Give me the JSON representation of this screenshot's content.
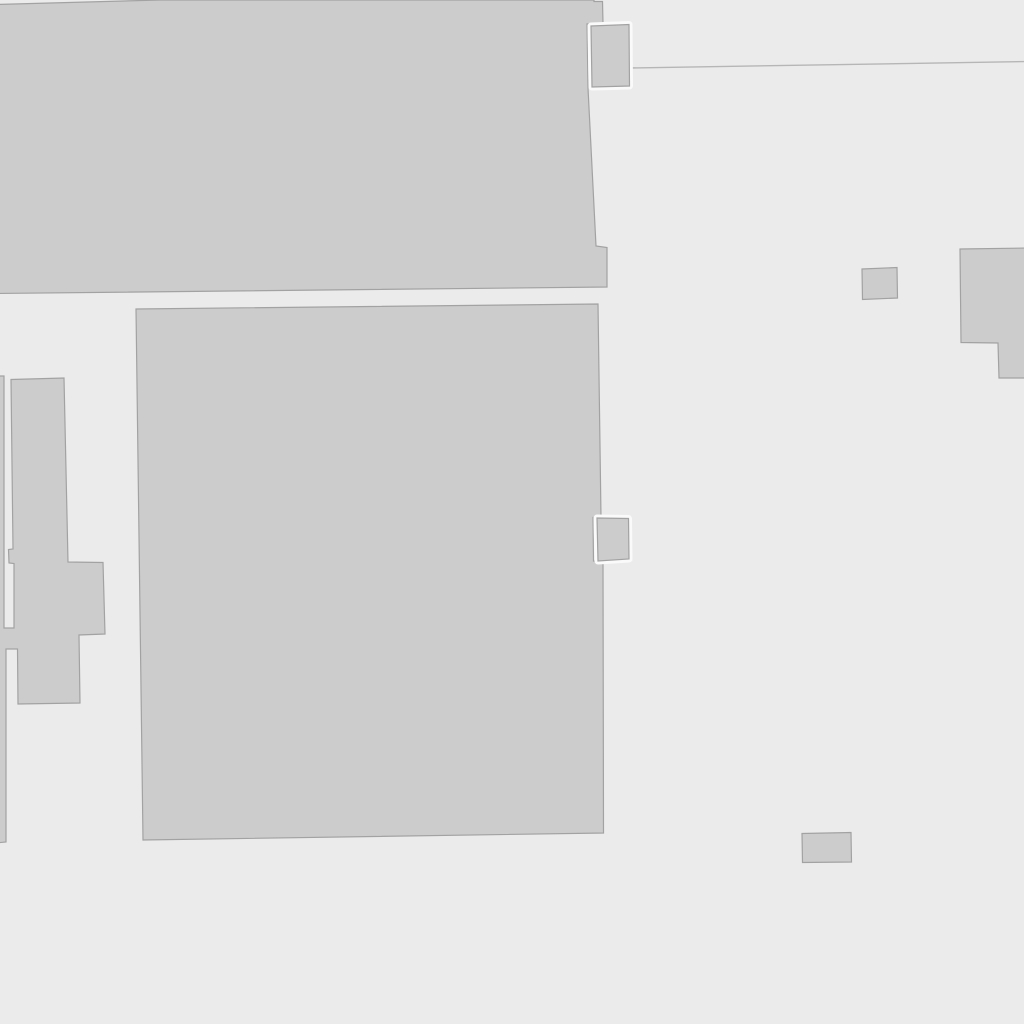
{
  "map": {
    "canvas": {
      "width": 1024,
      "height": 1024
    },
    "colors": {
      "background": "#ebebeb",
      "building_fill": "#cccccc",
      "building_stroke": "#a2a2a2",
      "halo": "#fafafa",
      "boundary_line": "#b6b6b6"
    },
    "shapes": [
      {
        "data_name": "building-footprint-top-left",
        "type": "polygon",
        "interactable": true,
        "fill": "building_fill",
        "stroke": "building_stroke",
        "stroke_width": 1.2,
        "points": [
          [
            -4,
            4.5
          ],
          [
            160,
            0
          ],
          [
            594,
            0
          ],
          [
            594,
            1.5
          ],
          [
            602.5,
            1.5
          ],
          [
            603,
            23
          ],
          [
            587,
            24
          ],
          [
            588,
            88
          ],
          [
            596,
            246
          ],
          [
            607,
            247.5
          ],
          [
            607,
            287
          ],
          [
            -4,
            293.5
          ]
        ]
      },
      {
        "data_name": "building-footprint-left-complex",
        "type": "polygon",
        "interactable": true,
        "fill": "building_fill",
        "stroke": "building_stroke",
        "stroke_width": 1.2,
        "points": [
          [
            11,
            379.5
          ],
          [
            64,
            378
          ],
          [
            68,
            562
          ],
          [
            103,
            562.5
          ],
          [
            105,
            634
          ],
          [
            79,
            635
          ],
          [
            80,
            703
          ],
          [
            18,
            704
          ],
          [
            17.5,
            649
          ],
          [
            6,
            649
          ],
          [
            6,
            842
          ],
          [
            -5,
            843
          ],
          [
            -5,
            376
          ],
          [
            4,
            376
          ],
          [
            4,
            628
          ],
          [
            14,
            628
          ],
          [
            14,
            563.5
          ],
          [
            9,
            563
          ],
          [
            8.5,
            549.5
          ],
          [
            13,
            549
          ]
        ]
      },
      {
        "data_name": "building-footprint-center-large",
        "type": "polygon",
        "interactable": true,
        "fill": "building_fill",
        "stroke": "building_stroke",
        "stroke_width": 1.2,
        "points": [
          [
            136,
            309
          ],
          [
            598,
            304
          ],
          [
            601,
            517
          ],
          [
            593,
            517.5
          ],
          [
            593.5,
            561
          ],
          [
            603,
            561.5
          ],
          [
            603.5,
            833
          ],
          [
            143,
            840
          ]
        ]
      },
      {
        "data_name": "boundary-line",
        "type": "polyline",
        "interactable": false,
        "stroke": "boundary_line",
        "stroke_width": 1.4,
        "points": [
          [
            629,
            68
          ],
          [
            1030,
            61.5
          ]
        ]
      },
      {
        "data_name": "building-footprint-small-top",
        "type": "polygon",
        "interactable": true,
        "halo": true,
        "halo_width": 7,
        "fill": "building_fill",
        "stroke": "building_stroke",
        "stroke_width": 1.2,
        "points": [
          [
            591,
            26
          ],
          [
            629,
            24.5
          ],
          [
            629.5,
            86
          ],
          [
            592,
            87
          ]
        ]
      },
      {
        "data_name": "building-footprint-small-middle",
        "type": "polygon",
        "interactable": true,
        "halo": true,
        "halo_width": 7,
        "fill": "building_fill",
        "stroke": "building_stroke",
        "stroke_width": 1.2,
        "points": [
          [
            597,
            518
          ],
          [
            628.5,
            518.5
          ],
          [
            629,
            559
          ],
          [
            598,
            561
          ]
        ]
      },
      {
        "data_name": "building-footprint-small-square-right",
        "type": "polygon",
        "interactable": true,
        "fill": "building_fill",
        "stroke": "building_stroke",
        "stroke_width": 1.2,
        "points": [
          [
            862,
            269
          ],
          [
            897,
            267.5
          ],
          [
            897.5,
            298
          ],
          [
            862.5,
            299.5
          ]
        ]
      },
      {
        "data_name": "building-footprint-right-edge-L",
        "type": "polygon",
        "interactable": true,
        "fill": "building_fill",
        "stroke": "building_stroke",
        "stroke_width": 1.2,
        "points": [
          [
            960,
            249
          ],
          [
            1030,
            248
          ],
          [
            1030,
            378
          ],
          [
            999,
            378
          ],
          [
            998,
            343
          ],
          [
            961,
            342.5
          ]
        ]
      },
      {
        "data_name": "building-footprint-small-bottom",
        "type": "polygon",
        "interactable": true,
        "fill": "building_fill",
        "stroke": "building_stroke",
        "stroke_width": 1.2,
        "points": [
          [
            802,
            833.5
          ],
          [
            851,
            832.5
          ],
          [
            851.5,
            862
          ],
          [
            802.5,
            862.5
          ]
        ]
      }
    ]
  }
}
